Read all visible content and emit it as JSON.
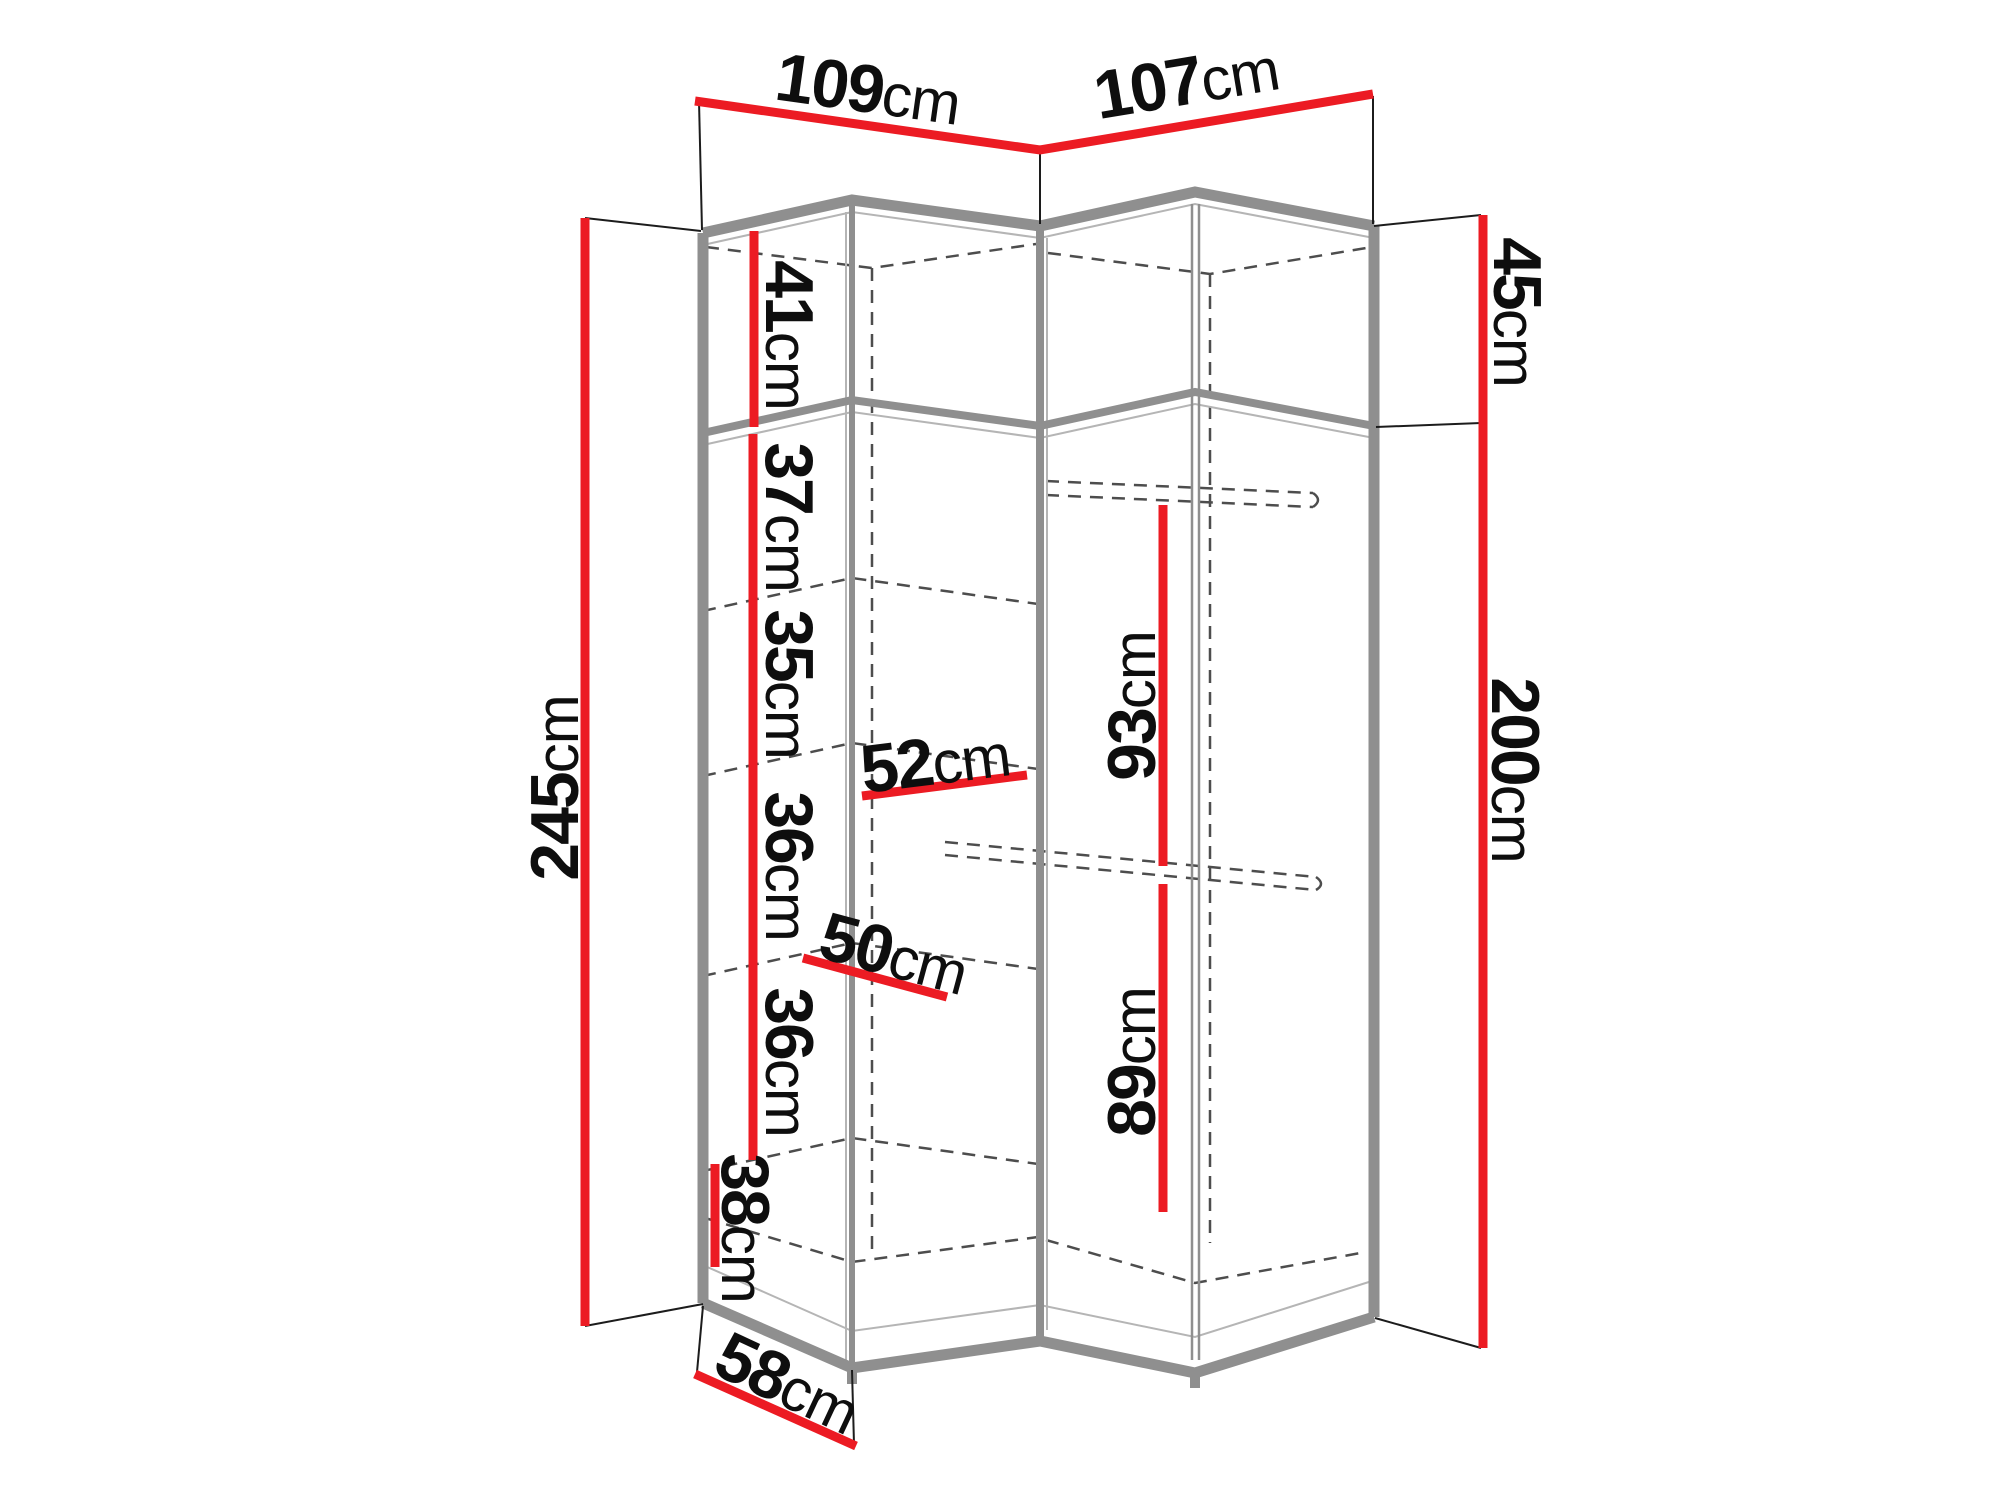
{
  "diagram": {
    "type": "corner-wardrobe-dimension-drawing",
    "unit_system": "cm"
  },
  "dimensions": {
    "width_left": {
      "value": "109",
      "unit": "cm"
    },
    "width_right": {
      "value": "107",
      "unit": "cm"
    },
    "height_total": {
      "value": "245",
      "unit": "cm"
    },
    "top_section_height": {
      "value": "45",
      "unit": "cm"
    },
    "body_height": {
      "value": "200",
      "unit": "cm"
    },
    "shelf_gaps": [
      {
        "value": "41",
        "unit": "cm"
      },
      {
        "value": "37",
        "unit": "cm"
      },
      {
        "value": "35",
        "unit": "cm"
      },
      {
        "value": "36",
        "unit": "cm"
      },
      {
        "value": "36",
        "unit": "cm"
      },
      {
        "value": "38",
        "unit": "cm"
      }
    ],
    "shelf_width": {
      "value": "52",
      "unit": "cm"
    },
    "shelf_depth": {
      "value": "50",
      "unit": "cm"
    },
    "side_depth": {
      "value": "58",
      "unit": "cm"
    },
    "hanging_space_top": {
      "value": "93",
      "unit": "cm"
    },
    "hanging_space_bottom": {
      "value": "89",
      "unit": "cm"
    }
  },
  "colors": {
    "dimension_line": "#ec1b23",
    "cabinet_edge": "#8f8f8f",
    "cabinet_edge_light": "#b5b5b5",
    "hidden_edge": "#4d4d4d",
    "tick_line": "#1c1c1c",
    "text": "#0e0e0e"
  }
}
